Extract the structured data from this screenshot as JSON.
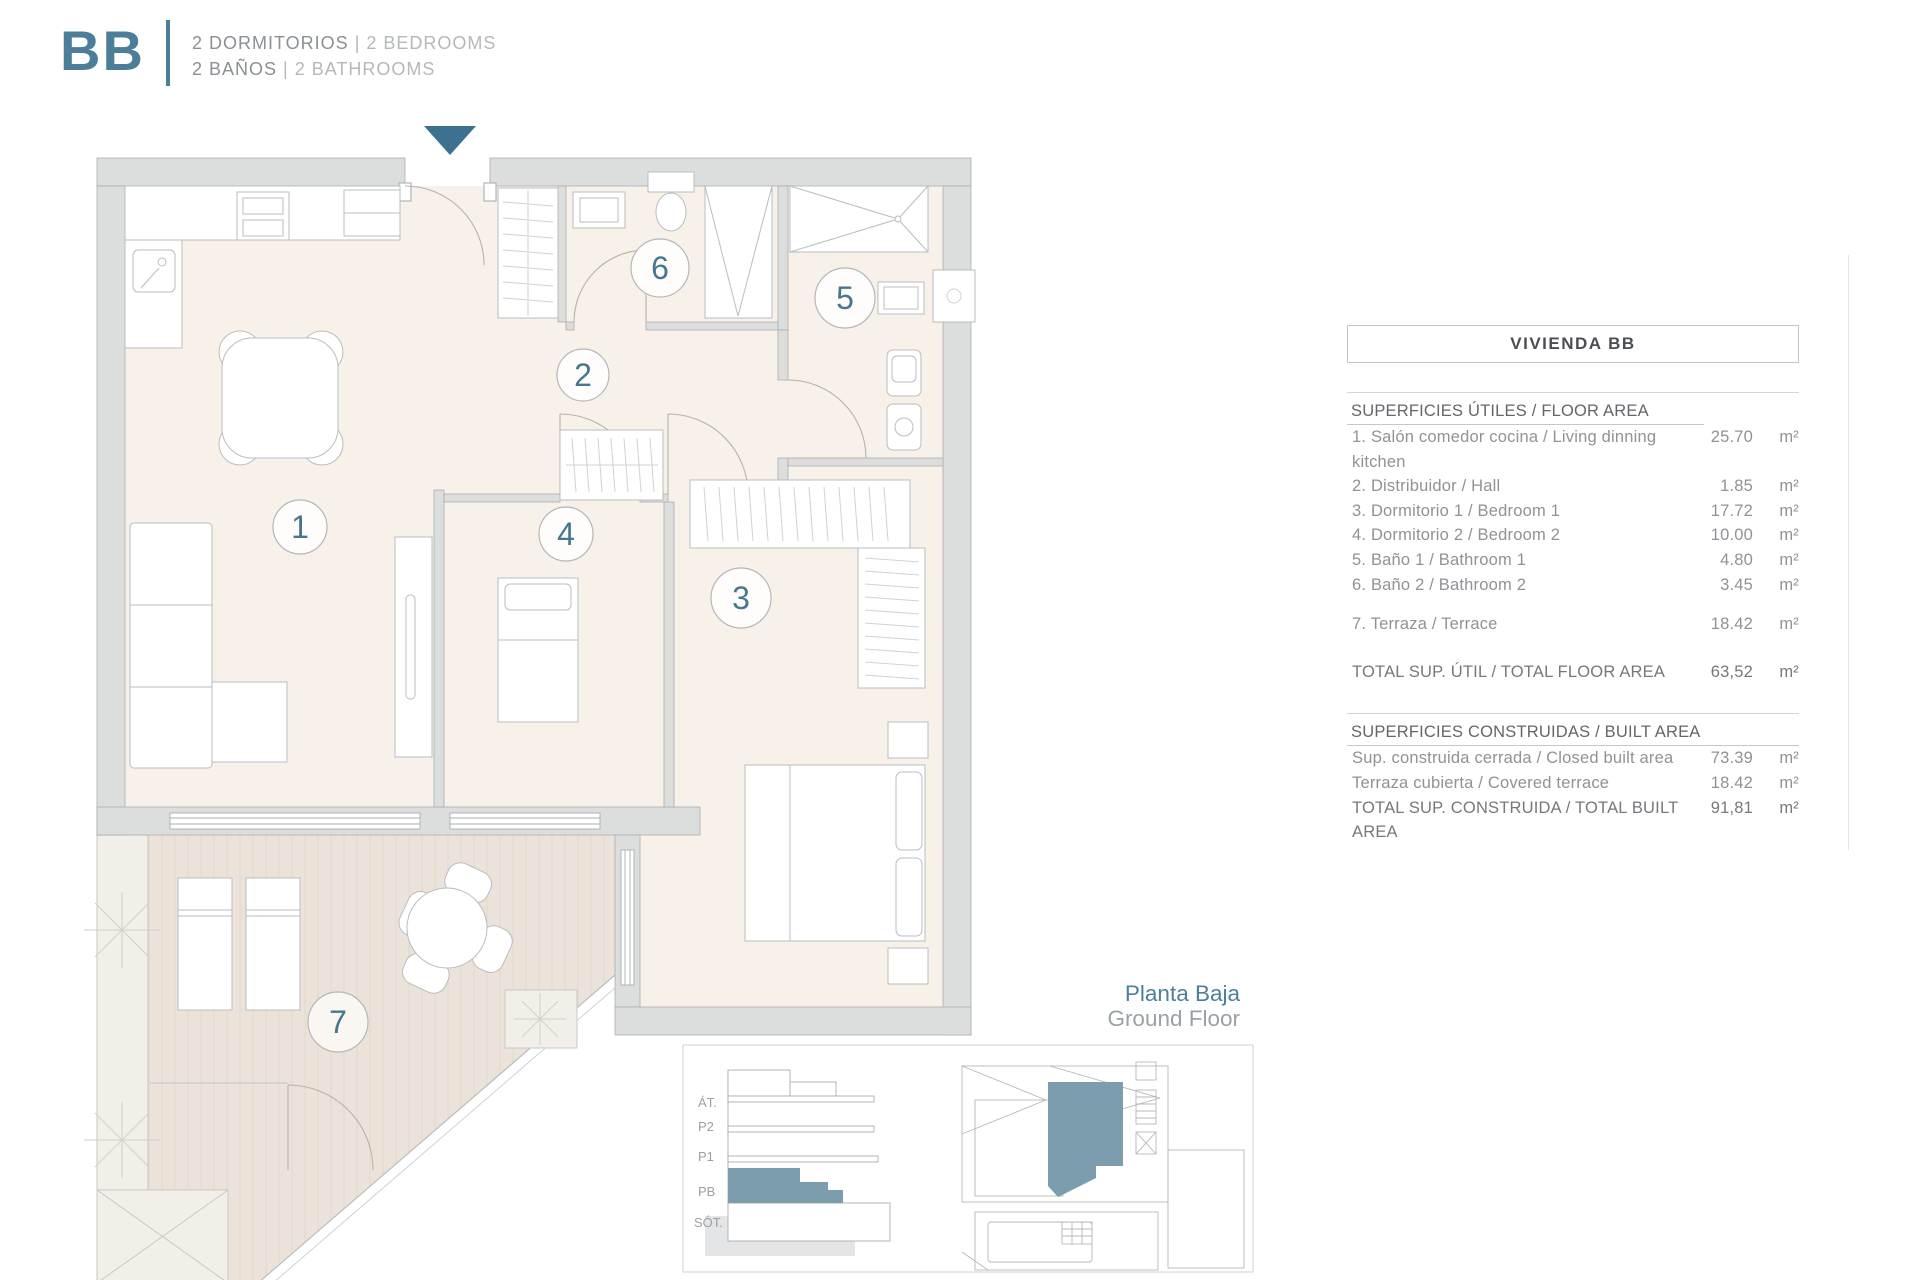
{
  "header": {
    "logo": "BB",
    "separator": "|",
    "line1": {
      "es": "2 DORMITORIOS",
      "en": "2 BEDROOMS"
    },
    "line2": {
      "es": "2 BAÑOS",
      "en": "2 BATHROOMS"
    }
  },
  "plan": {
    "rooms": [
      {
        "number": "1",
        "name": "living-dining-kitchen"
      },
      {
        "number": "2",
        "name": "hall"
      },
      {
        "number": "3",
        "name": "bedroom-1"
      },
      {
        "number": "4",
        "name": "bedroom-2"
      },
      {
        "number": "5",
        "name": "bathroom-1"
      },
      {
        "number": "6",
        "name": "bathroom-2"
      },
      {
        "number": "7",
        "name": "terrace"
      }
    ],
    "floor_label": {
      "es": "Planta Baja",
      "en": "Ground Floor"
    }
  },
  "mini_diagram": {
    "levels": [
      {
        "label": "ÁT."
      },
      {
        "label": "P2"
      },
      {
        "label": "P1"
      },
      {
        "label": "PB"
      },
      {
        "label": "SÓT."
      }
    ]
  },
  "colors": {
    "accent_teal": "#44788f",
    "mini_teal": "#7b9dad",
    "wall_gray": "#dcdddd",
    "floor": "#f8f1ea",
    "terrace": "#ebe3da"
  },
  "table": {
    "title": "VIVIENDA BB",
    "sections": [
      {
        "header": "SUPERFICIES ÚTILES / FLOOR AREA",
        "rows": [
          {
            "label": "1. Salón comedor cocina / Living dinning kitchen",
            "value": "25.70",
            "unit": "m²"
          },
          {
            "label": "2. Distribuidor / Hall",
            "value": "1.85",
            "unit": "m²"
          },
          {
            "label": "3. Dormitorio 1 / Bedroom 1",
            "value": "17.72",
            "unit": "m²"
          },
          {
            "label": "4. Dormitorio 2 / Bedroom 2",
            "value": "10.00",
            "unit": "m²"
          },
          {
            "label": "5. Baño 1 / Bathroom 1",
            "value": "4.80",
            "unit": "m²"
          },
          {
            "label": "6. Baño 2 / Bathroom 2",
            "value": "3.45",
            "unit": "m²"
          },
          {
            "label": "7. Terraza / Terrace",
            "value": "18.42",
            "unit": "m²"
          }
        ],
        "total": {
          "label": "TOTAL SUP. ÚTIL / TOTAL FLOOR AREA",
          "value": "63,52",
          "unit": "m²"
        }
      },
      {
        "header": "SUPERFICIES CONSTRUIDAS / BUILT AREA",
        "rows": [
          {
            "label": "Sup. construida cerrada / Closed built area",
            "value": "73.39",
            "unit": "m²"
          },
          {
            "label": "Terraza cubierta / Covered terrace",
            "value": "18.42",
            "unit": "m²"
          }
        ],
        "total": {
          "label": "TOTAL SUP. CONSTRUIDA /  TOTAL BUILT AREA",
          "value": "91,81",
          "unit": "m²"
        }
      }
    ]
  }
}
